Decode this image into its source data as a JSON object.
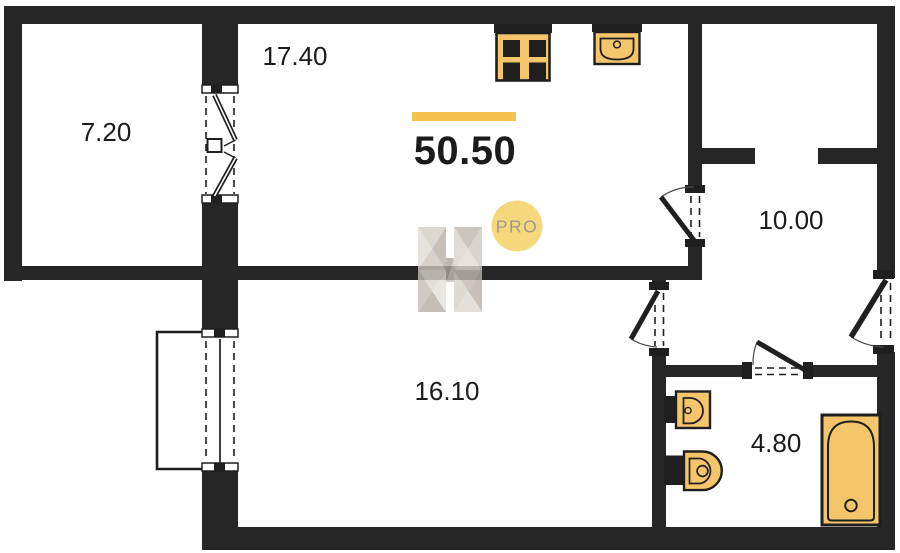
{
  "colors": {
    "wall": "#262626",
    "line": "#1f1f1f",
    "fixture": "#F5C56B",
    "accent": "#F2C14E",
    "badge-fill": "#F6D87C",
    "badge-text": "#9E978E",
    "label-text": "#1b1b1b",
    "bg": "#ffffff"
  },
  "plan": {
    "total_area": "50.50",
    "rooms": [
      {
        "name": "balcony",
        "area": "7.20"
      },
      {
        "name": "living-kitchen",
        "area": "17.40"
      },
      {
        "name": "hallway",
        "area": "10.00"
      },
      {
        "name": "room",
        "area": "16.10"
      },
      {
        "name": "bathroom",
        "area": "4.80"
      }
    ],
    "watermark": {
      "badge": "PRO"
    },
    "fixtures": [
      "stove-icon",
      "kitchen-sink-icon",
      "washbasin-icon",
      "toilet-icon",
      "bathtub-icon"
    ]
  }
}
